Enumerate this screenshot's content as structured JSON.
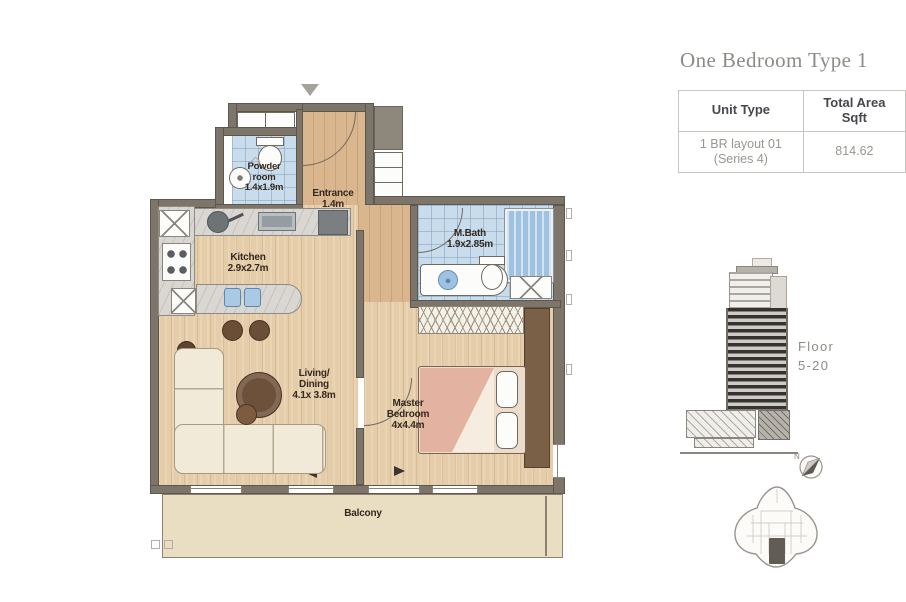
{
  "document": {
    "title": "One Bedroom Type 1"
  },
  "spec_table": {
    "columns": [
      "Unit Type",
      "Total Area Sqft"
    ],
    "row": {
      "unit_type_line1": "1 BR layout 01",
      "unit_type_line2": "(Series 4)",
      "total_area_sqft": "814.62"
    }
  },
  "floor_plan": {
    "rooms": {
      "powder": {
        "line1": "Powder",
        "line2": "room",
        "dim": "1.4x1.9m"
      },
      "entrance": {
        "name": "Entrance",
        "dim": "1.4m"
      },
      "kitchen": {
        "name": "Kitchen",
        "dim": "2.9x2.7m"
      },
      "mbath": {
        "name": "M.Bath",
        "dim": "1.9x2.85m"
      },
      "living": {
        "line1": "Living/",
        "line2": "Dining",
        "dim": "4.1x 3.8m"
      },
      "master": {
        "line1": "Master",
        "line2": "Bedroom",
        "dim": "4x4.4m"
      },
      "balcony": {
        "name": "Balcony"
      }
    }
  },
  "building": {
    "floor_line1": "Floor",
    "floor_line2": "5-20"
  },
  "keyplan": {
    "north": "N"
  },
  "colors": {
    "tile_blue": "#c9dcec",
    "wood_tan": "#e6cdaa",
    "entry_wood": "#d9b68e",
    "wall_gray": "#7d7569",
    "balcony_cream": "#e9ddc2",
    "bed_blush": "#e3b2a0",
    "title_gray": "#8c8b86"
  }
}
